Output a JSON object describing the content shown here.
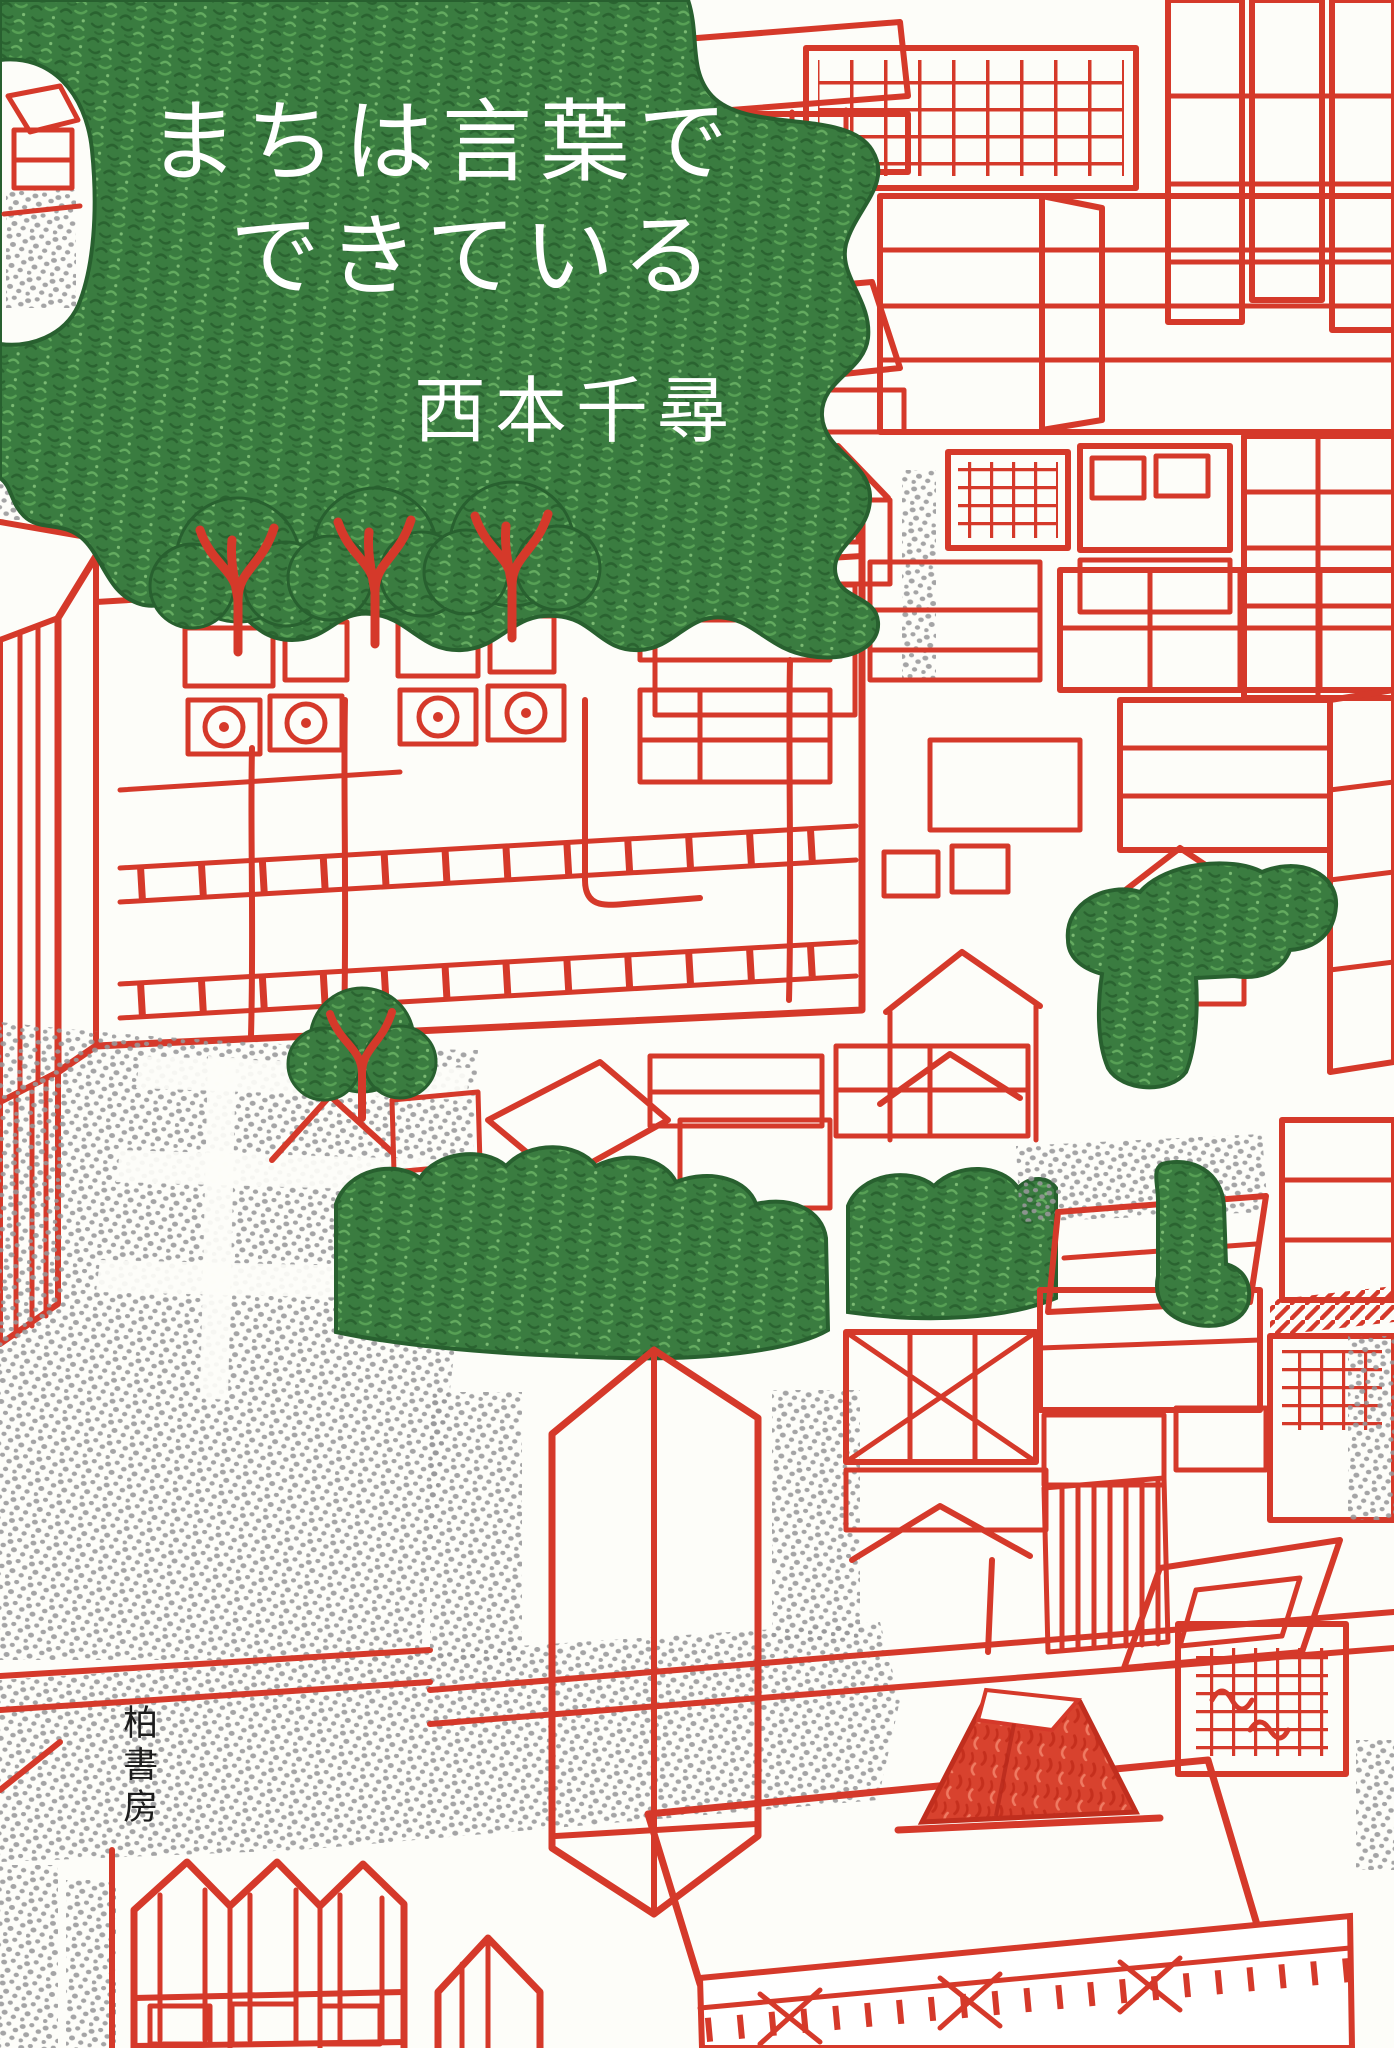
{
  "book": {
    "title_line1": "まちは言葉で",
    "title_line2": "できている",
    "author": "西本千尋",
    "publisher": "柏書房"
  },
  "palette": {
    "ink_red": "#d5392a",
    "leaf_green": "#3a7c40",
    "leaf_green_dark": "#28602f",
    "stipple_gray": "#98989a",
    "paper_white": "#fdfdf9",
    "title_white": "#ffffff",
    "publisher_black": "#1c1c1c"
  }
}
